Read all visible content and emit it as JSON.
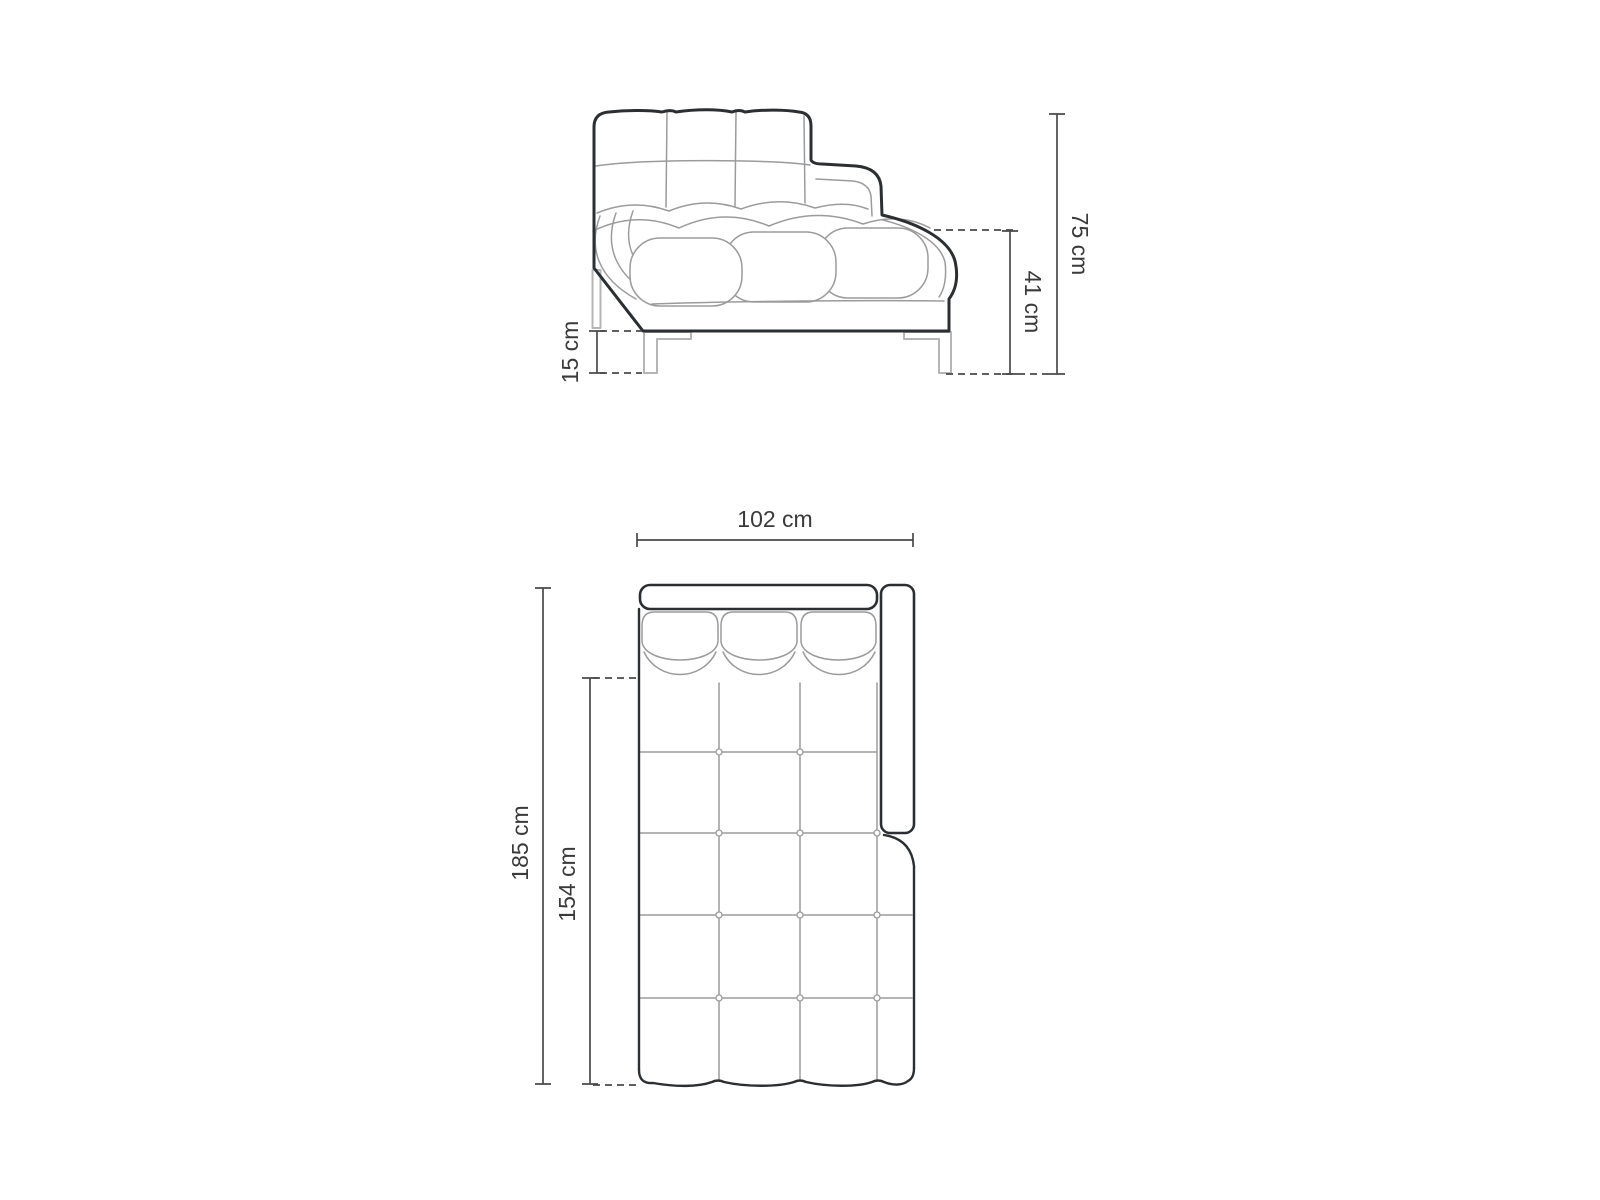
{
  "side_view": {
    "dimensions": {
      "total_height": "75 cm",
      "seat_height": "41 cm",
      "base_clearance": "15 cm"
    }
  },
  "top_view": {
    "dimensions": {
      "total_width": "102 cm",
      "total_length": "185 cm",
      "chaise_length": "154 cm"
    }
  },
  "colors": {
    "outline": "#2b2f32",
    "detail_line": "#9b9b9b",
    "leg_line": "#b5b5b5",
    "dimension_line": "#4a4a4a",
    "label_text": "#3a3a3a",
    "background": "#ffffff"
  }
}
